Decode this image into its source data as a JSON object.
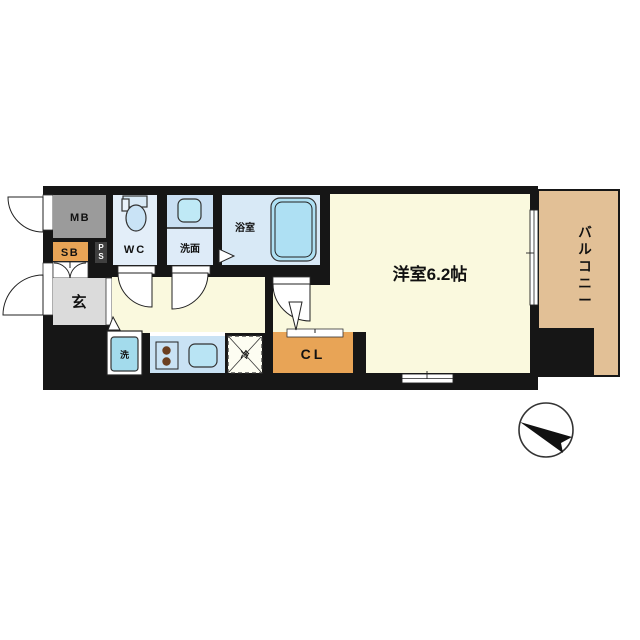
{
  "floor_plan": {
    "rooms": {
      "meter_box": {
        "label": "MB"
      },
      "shoe_box": {
        "label": "SB"
      },
      "pipe_space": {
        "label": "PS"
      },
      "toilet_room": {
        "label": "WC"
      },
      "washroom": {
        "label": "洗面"
      },
      "bathroom": {
        "label": "浴室"
      },
      "entrance": {
        "label": "玄"
      },
      "closet": {
        "label": "CL"
      },
      "main_room": {
        "label": "洋室6.2帖"
      },
      "balcony": {
        "label": "バルコニー"
      }
    },
    "fixtures": {
      "washing_machine": {
        "label": "洗"
      },
      "refrigerator": {
        "label": "冷"
      }
    },
    "colors": {
      "wall": "#161616",
      "floor_cream": "#FAF9DE",
      "balcony_tan": "#E2C096",
      "closet_orange": "#E8A456",
      "meter_box_gray": "#9B9B9B",
      "entrance_gray": "#DBDBDB",
      "pipe_space_dark": "#3F3F3F",
      "wc_blue": "#E3EEF9",
      "washroom_blue": "#DEEBF8",
      "washroom_top_blue": "#C9DFF3",
      "bathroom_blue": "#D8E9F6",
      "bathtub_blue": "#AEE0F3",
      "counter_blue": "#C9E2F4",
      "washer_blue": "#A3DBEC",
      "kitchen_sink_blue": "#B9E4F4",
      "sink_blue": "#BFE9F6",
      "toilet_blue": "#C9E3F6",
      "burner_brown": "#6B3F20"
    }
  }
}
